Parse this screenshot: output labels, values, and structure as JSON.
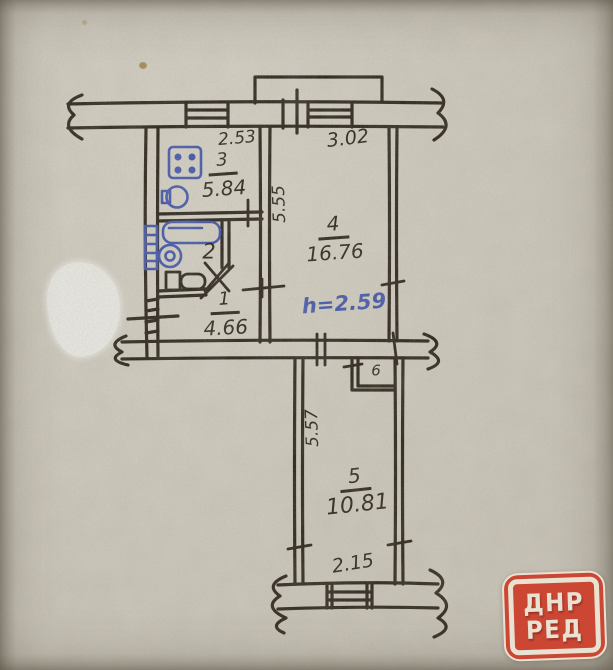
{
  "palette": {
    "paper": "#c9c4b8",
    "ink": "#241d14",
    "blue_ink": "#3c51a8",
    "watermark_red": "#cb4734",
    "watermark_cream": "#e9e2d2",
    "whiteout": "#e8e7e2"
  },
  "plan": {
    "rooms": [
      {
        "name": "kitchen",
        "number": "3",
        "area_m2": "5.84"
      },
      {
        "name": "bathroom",
        "number": "2",
        "area_m2": ""
      },
      {
        "name": "hallway",
        "number": "1",
        "area_m2": "4.66"
      },
      {
        "name": "living-room",
        "number": "4",
        "area_m2": "16.76"
      },
      {
        "name": "room-5",
        "number": "5",
        "area_m2": "10.81"
      },
      {
        "name": "closet",
        "number": "6",
        "area_m2": ""
      }
    ],
    "dimensions": {
      "kitchen_width": "2.53",
      "living_width": "3.02",
      "living_depth": "5.55",
      "room5_depth": "5.57",
      "room5_width": "2.15"
    },
    "notes": {
      "ceiling_height": "h=2.59"
    },
    "fixtures": [
      "stove-icon",
      "kitchen-sink-icon",
      "bathtub-icon",
      "washbasin-icon",
      "towel-radiator-icon",
      "toilet-icon"
    ]
  },
  "watermark": {
    "line1": "ДНР",
    "line2": "РЕД"
  }
}
